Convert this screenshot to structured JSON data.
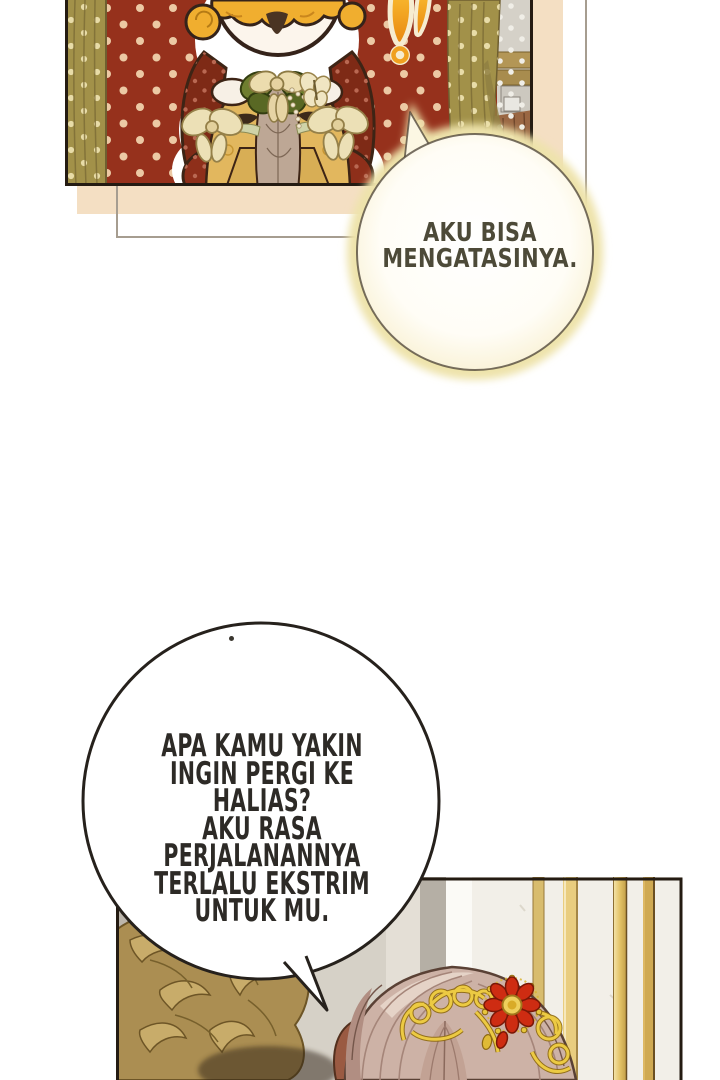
{
  "comic": {
    "speech_bubbles": {
      "small": {
        "text": "AKU BISA\nMENGATASINYA.",
        "shape": "round-with-glow",
        "tail_direction": "up-left",
        "text_color": "#4d4a38"
      },
      "large": {
        "text": "APA KAMU YAKIN\nINGIN PERGI KE HALIAS?\nAKU RASA PERJALANANNYA\nTERLALU EKSTRIM\nUNTUK MU.",
        "shape": "round",
        "tail_direction": "down-right",
        "text_color": "#2d2a26"
      }
    },
    "icons": {
      "exclamation": "exclamation-mark"
    },
    "colors": {
      "page_background": "#ffffff",
      "panel_border": "#241b12",
      "red_wall": "#96311c",
      "wall_dots": "#ecc9a4",
      "curtain_olive": "#a29149",
      "backing_beige": "#f4dfc3",
      "backing_outline": "#a69d90",
      "bubble_glow": "#eee3ab",
      "bubble_outline": "#2b241c",
      "character_hair_orange": "#f0ae2f",
      "cape_red": "#7e2a16",
      "dress_gold": "#e2b75e",
      "ornament_gold": "#ab8e52",
      "filigree_gold": "#ecca43",
      "gem_red": "#ce2c12",
      "hair_rose_beige": "#cdb2a6",
      "wall_bottom": "#f2efe8"
    }
  }
}
